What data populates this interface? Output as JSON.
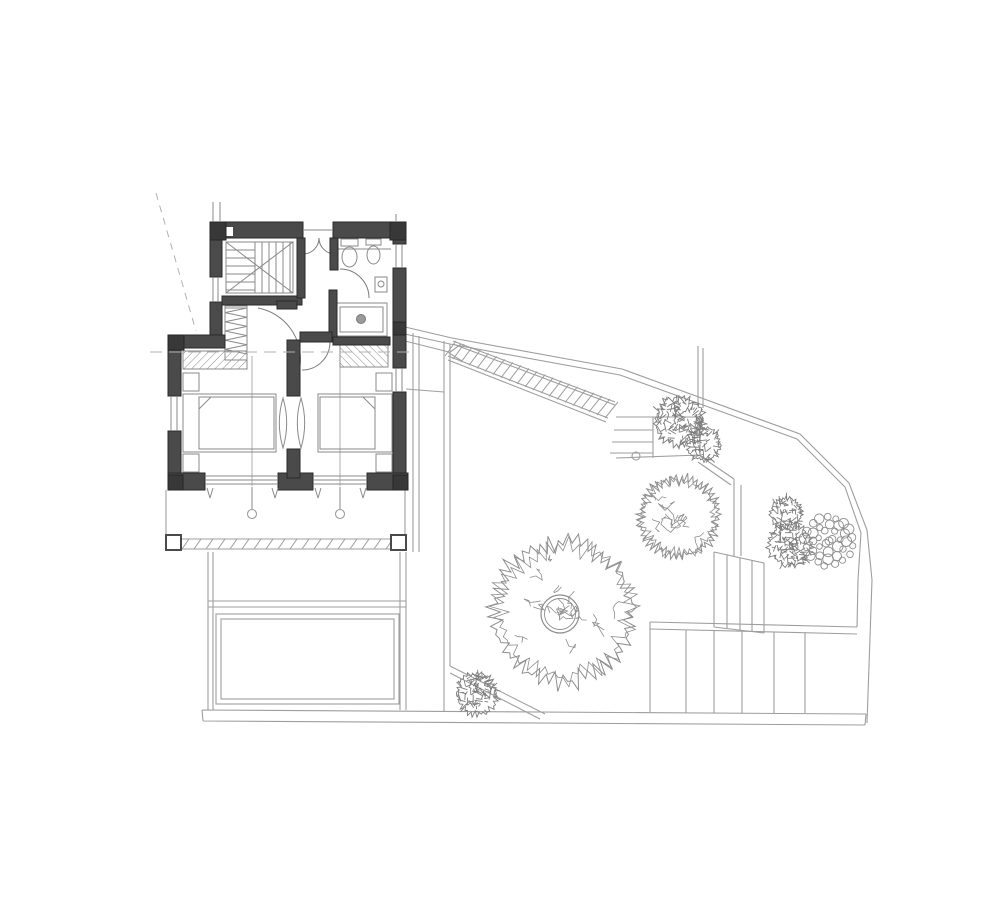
{
  "drawing": {
    "kind": "architectural floor plan with garden, no visible text labels",
    "palette": {
      "background": "#ffffff",
      "wall_fill": "#4a4a4a",
      "wall_corner": "#383838",
      "wall_edge": "#2a2a2a",
      "site_line": "#9e9e9e",
      "furniture_line": "#8a8a8a",
      "tree_line": "#8e8e8e",
      "bush_line": "#7d7d7d",
      "dash_line": "#b0b0b0"
    },
    "garden": {
      "long_stair": {
        "tread_count": 21,
        "top_rail": [
          453,
          341,
          615,
          402
        ],
        "bottom_rail": [
          448,
          356,
          608,
          418
        ],
        "arrow": [
          [
            461,
            344
          ],
          [
            449,
            353
          ],
          [
            462,
            361
          ]
        ]
      },
      "mid_stair": {
        "tread_ys": [
          417,
          430,
          442,
          453
        ],
        "x1": 616,
        "x2": 653,
        "post_circle": [
          636,
          456,
          4
        ]
      },
      "terrace": {
        "step_columns": [
          686,
          714,
          742,
          774,
          805
        ],
        "top_edge": [
          650,
          629,
          857,
          634
        ],
        "bottom_y": 713,
        "small_stair_columns": [
          714,
          727,
          740,
          752,
          764
        ],
        "small_stair_top": [
          714,
          552,
          764,
          563
        ],
        "small_stair_bottom": [
          714,
          627,
          764,
          633
        ]
      },
      "trees": [
        {
          "kind": "canopy-outline",
          "cx": 563,
          "cy": 612,
          "r": 75,
          "seed": 7,
          "trunk_ring": true
        },
        {
          "kind": "canopy-outline",
          "cx": 679,
          "cy": 517,
          "r": 42,
          "seed": 11,
          "trunk_ring": false
        },
        {
          "kind": "dense-bush",
          "cx": 679,
          "cy": 421,
          "r": 25,
          "seed": 3
        },
        {
          "kind": "dense-bush",
          "cx": 704,
          "cy": 444,
          "r": 17,
          "seed": 5
        },
        {
          "kind": "dense-bush",
          "cx": 786,
          "cy": 513,
          "r": 16,
          "seed": 9
        },
        {
          "kind": "dense-bush",
          "cx": 790,
          "cy": 545,
          "r": 22,
          "seed": 13
        },
        {
          "kind": "pebble-tree",
          "cx": 829,
          "cy": 541,
          "r": 28,
          "seed": 17
        },
        {
          "kind": "dense-bush",
          "cx": 477,
          "cy": 694,
          "r": 21,
          "seed": 21
        }
      ]
    },
    "building": {
      "closet_zigzag": {
        "x1": 225,
        "x2": 247,
        "y1": 308,
        "y2": 358,
        "step": 4.6
      },
      "balcony_hatch": {
        "x1": 170,
        "x2": 402,
        "y1": 549,
        "y2": 539,
        "step": 12
      }
    }
  }
}
